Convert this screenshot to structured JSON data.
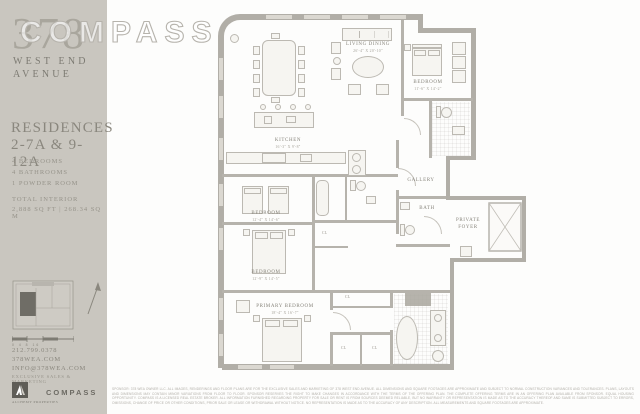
{
  "watermark": {
    "text": "COMPASS"
  },
  "sidebar": {
    "logo": {
      "number": "378",
      "line1": "WEST END",
      "line2": "AVENUE"
    },
    "residences_line1": "RESIDENCES",
    "residences_line2": "2-7A & 9-12A",
    "features": [
      "4 BEDROOMS",
      "4 BATHROOMS",
      "1 POWDER ROOM"
    ],
    "total_label": "TOTAL INTERIOR",
    "total_value": "2,888 SQ FT  |  268.34 SQ M",
    "scale_labels": "0   4   8         16",
    "contact": {
      "phone": "212.799.0378",
      "web": "378WEA.COM",
      "email": "INFO@378WEA.COM"
    },
    "sales_label": "EXCLUSIVE SALES & MARKETING",
    "alchemy_name": "ALCHEMY PROPERTIES",
    "compass_name": "COMPASS"
  },
  "floorplan": {
    "closet_label": "CL",
    "rooms": [
      {
        "name": "LIVING DINING",
        "dims": "26'-4\" X 20'-10\""
      },
      {
        "name": "KITCHEN",
        "dims": "16'-3\" X 9'-8\""
      },
      {
        "name": "BEDROOM",
        "dims": "11'-6\" X 14'-2\""
      },
      {
        "name": "GALLERY",
        "dims": ""
      },
      {
        "name": "BATH",
        "dims": ""
      },
      {
        "name": "PRIVATE FOYER",
        "dims": ""
      },
      {
        "name": "BEDROOM",
        "dims": "12'-4\" X 14'-6\""
      },
      {
        "name": "BEDROOM",
        "dims": "12'-9\" X 14'-5\""
      },
      {
        "name": "PRIMARY BEDROOM",
        "dims": "18'-4\" X 16'-7\""
      }
    ]
  },
  "disclaimer": "SPONSOR: 378 WEA OWNER LLC. ALL IMAGES, RENDERINGS AND FLOOR PLANS ARE FOR THE EXCLUSIVE SALES AND MARKETING OF 378 WEST END AVENUE. ALL DIMENSIONS AND SQUARE FOOTAGES ARE APPROXIMATE AND SUBJECT TO NORMAL CONSTRUCTION VARIANCES AND TOLERANCES. PLANS, LAYOUTS AND DIMENSIONS MAY CONTAIN MINOR VARIATIONS FROM FLOOR TO FLOOR. SPONSOR RESERVES THE RIGHT TO MAKE CHANGES IN ACCORDANCE WITH THE TERMS OF THE OFFERING PLAN. THE COMPLETE OFFERING TERMS ARE IN AN OFFERING PLAN AVAILABLE FROM SPONSOR. EQUAL HOUSING OPPORTUNITY. COMPASS IS A LICENSED REAL ESTATE BROKER. ALL INFORMATION FURNISHED REGARDING PROPERTY FOR SALE OR RENT IS FROM SOURCES DEEMED RELIABLE, BUT NO WARRANTY OR REPRESENTATION IS MADE AS TO THE ACCURACY THEREOF AND SAME IS SUBMITTED SUBJECT TO ERRORS, OMISSIONS, CHANGE OF PRICE OR OTHER CONDITIONS, PRIOR SALE OR LEASE OR WITHDRAWAL WITHOUT NOTICE. NO REPRESENTATION IS MADE AS TO THE ACCURACY OF ANY DESCRIPTION. ALL MEASUREMENTS AND SQUARE FOOTAGES ARE APPROXIMATE.",
  "colors": {
    "sidebar_bg": "#c9c6bf",
    "wall": "#b1aea7",
    "accent_text": "#8a877e"
  }
}
